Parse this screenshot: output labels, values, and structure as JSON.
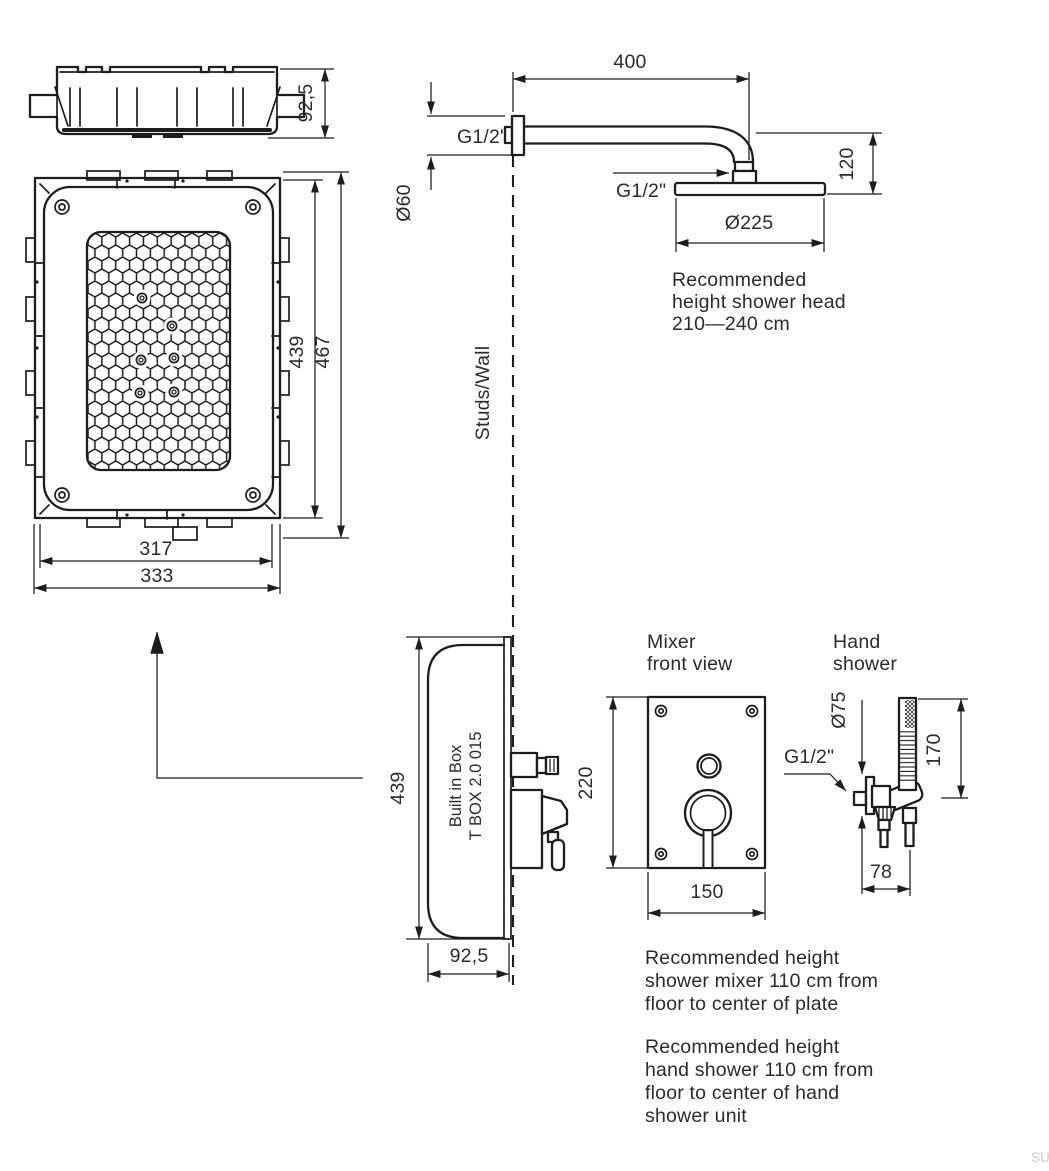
{
  "watermark": "SU",
  "colors": {
    "ink": "#1d1d1d",
    "background": "#ffffff",
    "watermark_gray": "#c9c9c9"
  },
  "box_top_view": {
    "dim_depth": "92,5"
  },
  "box_front_view": {
    "dim_inner_height": "439",
    "dim_outer_height": "467",
    "dim_inner_width": "317",
    "dim_outer_width": "333"
  },
  "shower_head_view": {
    "dim_arm_length": "400",
    "thread_wall": "G1/2\"",
    "thread_head": "G1/2\"",
    "dim_arm_diameter": "Ø60",
    "dim_head_drop": "120",
    "dim_head_diameter": "Ø225",
    "note_lines": [
      "Recommended",
      "height shower head",
      "210—240 cm"
    ]
  },
  "wall_line_label": "Studs/Wall",
  "box_side_view": {
    "label_lines": [
      "Built in Box",
      "T BOX 2.0 015"
    ],
    "dim_height": "439",
    "dim_depth": "92,5"
  },
  "mixer_view": {
    "title_lines": [
      "Mixer",
      "front view"
    ],
    "dim_height": "220",
    "dim_width": "150"
  },
  "hand_shower_view": {
    "title_lines": [
      "Hand",
      "shower"
    ],
    "thread": "G1/2\"",
    "dim_plate_diameter": "Ø75",
    "dim_unit_height": "170",
    "dim_wall_offset": "78"
  },
  "notes": {
    "mixer_note_lines": [
      "Recommended height",
      "shower mixer 110 cm from",
      "floor to center of plate"
    ],
    "hand_shower_note_lines": [
      "Recommended height",
      "hand shower 110 cm from",
      "floor to center of hand",
      "shower unit"
    ]
  }
}
